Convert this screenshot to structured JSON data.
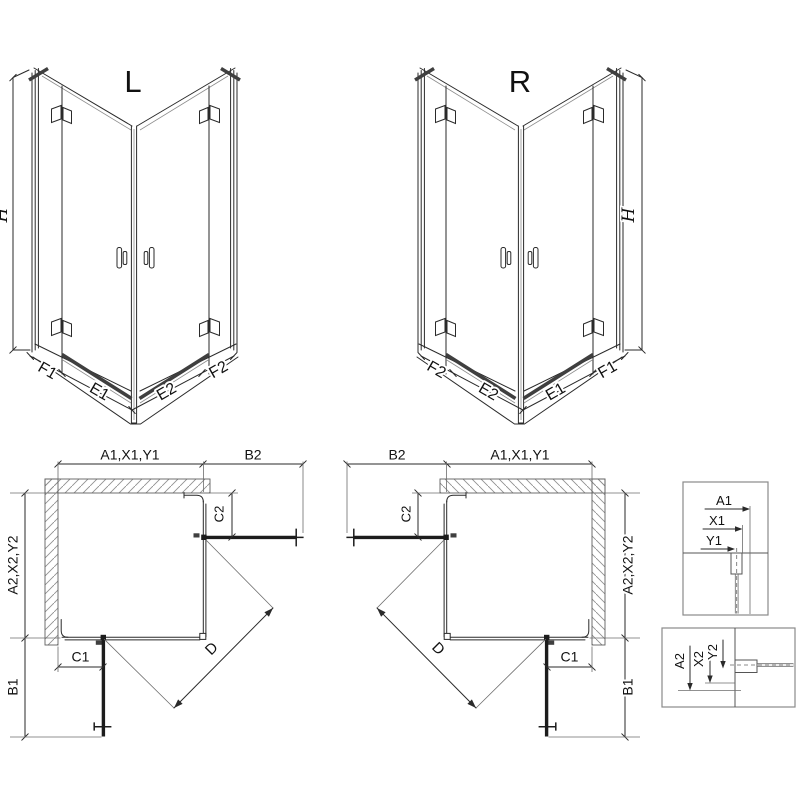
{
  "colors": {
    "background": "#ffffff",
    "line": "#2a2a2a",
    "thin_line": "#8c8c8c",
    "thick_line": "#1c1c1c",
    "rail": "#3f3f3f",
    "hatch": "#909090",
    "detail_box_border": "#8a8a8a",
    "text": "#111111"
  },
  "iso_views": {
    "left": {
      "title": "L",
      "height_dim": "H",
      "bottom_dims": [
        "F1",
        "E1",
        "E2",
        "F2"
      ]
    },
    "right": {
      "title": "R",
      "height_dim": "H",
      "bottom_dims": [
        "F2",
        "E2",
        "E1",
        "F1"
      ]
    }
  },
  "plan_views": {
    "left": {
      "top_dims": [
        "A1,X1,Y1",
        "B2"
      ],
      "side_dims": [
        "A2,X2,Y2",
        "B1"
      ],
      "inner_dims": {
        "c2": "C2",
        "c1": "C1",
        "diagonal": "D"
      }
    },
    "right": {
      "top_dims": [
        "B2",
        "A1,X1,Y1"
      ],
      "side_dims": [
        "A2,X2,Y2",
        "B1"
      ],
      "inner_dims": {
        "c2": "C2",
        "c1": "C1",
        "diagonal": "D"
      }
    }
  },
  "detail_views": {
    "top": {
      "dims": [
        "A1",
        "X1",
        "Y1"
      ]
    },
    "bottom": {
      "dims": [
        "A2",
        "X2",
        "Y2"
      ]
    }
  }
}
